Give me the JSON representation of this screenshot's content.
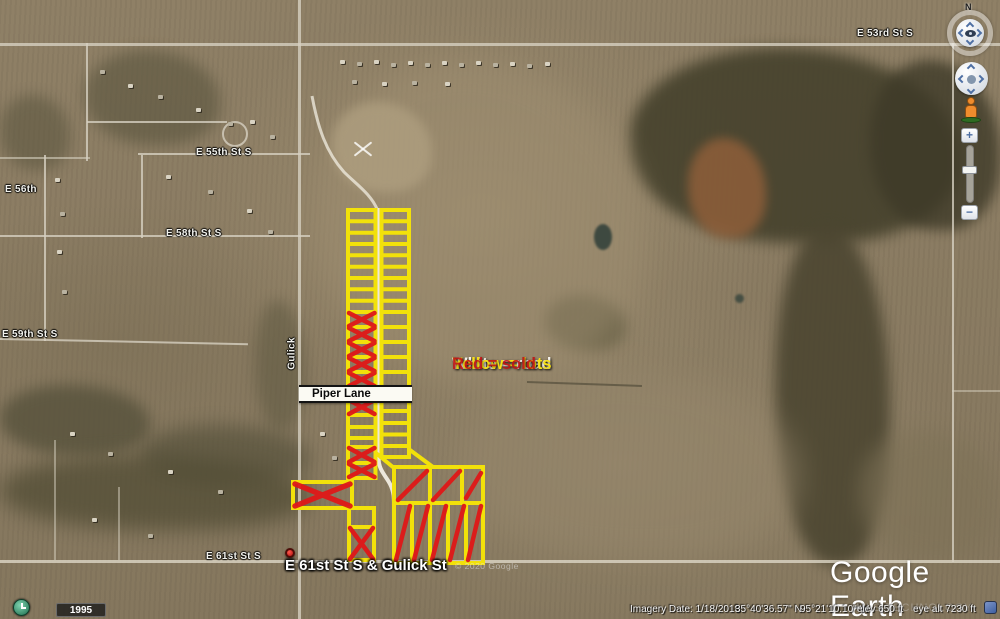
{
  "colors": {
    "lot_yellow": "#f2e10a",
    "sold_red": "#e01818",
    "road_white": "#f1ede1",
    "terrain_tan": "#8a7b61"
  },
  "legend": {
    "road": "White = road",
    "lots": "Yellow = lots",
    "sold": "Red = sold"
  },
  "roads": {
    "e53": "E 53rd St S",
    "e55": "E 55th St S",
    "e56": "E 56th",
    "e58": "E 58th St S",
    "e59": "E 59th St S",
    "e61": "E 61st St S",
    "gulick": "Gulick",
    "piper": "Piper Lane"
  },
  "placemark": {
    "label": "E 61st St S & Gulick St"
  },
  "watermarks": {
    "copyright": "© 2020 Google",
    "logo": "Google Earth",
    "mls": "MLS TECHNOLOGY"
  },
  "status_bar": {
    "imagery_date": "Imagery Date: 1/18/2018",
    "lat": "35°40'36.57\" N",
    "lon": "95°21'10.10\" W",
    "elev": "elev 650 ft",
    "eye_alt": "eye alt 7230 ft"
  },
  "history": {
    "year": "1995"
  },
  "nav": {
    "north": "N",
    "zoom_in": "+",
    "zoom_out": "−"
  }
}
